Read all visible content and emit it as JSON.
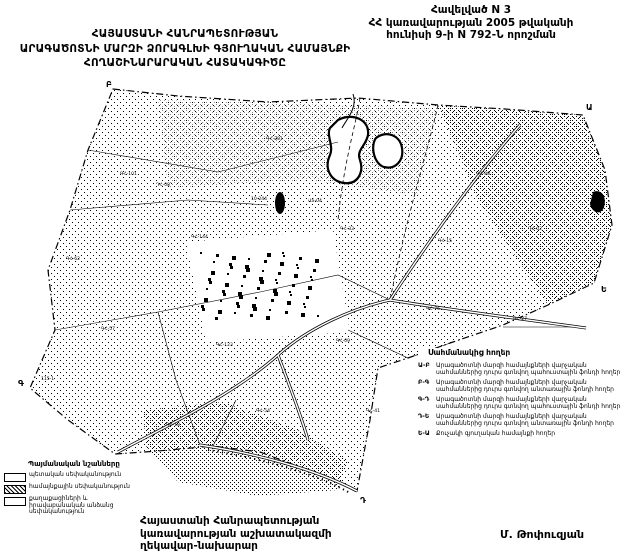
{
  "header": {
    "annex": {
      "line1": "Հավելված N 3",
      "line2": "ՀՀ կառավարության 2005 թվականի",
      "line3": "հունիսի 9-ի N 792-Ն որոշման"
    },
    "title": {
      "line1": "ՀԱՅԱՍՏԱՆԻ ՀԱՆՐԱՊԵՏՈՒԹՅԱՆ",
      "line2": "ԱՐԱԳԱԾՈՏՆԻ ՄԱՐԶԻ ՁՈՐԱԳԼԽԻ ԳՅՈՒՂԱԿԱՆ ՀԱՄԱՅՆՔԻ",
      "line3": "ՀՈՂԱՇԻՆԱՐԱՐԱԿԱՆ ՀԱՏԱԿԱԳԻԾԸ"
    }
  },
  "legend": {
    "title": "Պայմանական նշանները",
    "items": [
      {
        "swatch": "plain",
        "label": "պետական սեփականություն"
      },
      {
        "swatch": "dots",
        "label": "համայնքային սեփականություն"
      },
      {
        "swatch": "plain",
        "label": "քաղաքացիների և իրավաբանական անձանց սեփականություն"
      }
    ]
  },
  "adjacent_lands": {
    "title": "Սահմանակից հողեր",
    "entries": [
      {
        "code": "Ա-Բ",
        "text": "Արագածոտնի մարզի համայնքների վարչական սահմաններից դուրս գտնվող պահուստային ֆոնդի հողեր"
      },
      {
        "code": "Բ-Գ",
        "text": "Արագածոտնի մարզի համայնքների վարչական սահմաններից դուրս գտնվող անտառային ֆոնդի հողեր"
      },
      {
        "code": "Գ-Դ",
        "text": "Արագածոտնի մարզի համայնքների վարչական սահմաններից դուրս գտնվող պահուստային ֆոնդի հողեր"
      },
      {
        "code": "Դ-Ե",
        "text": "Արագածոտնի մարզի համայնքների վարչական սահմաններից դուրս գտնվող անտառային ֆոնդի հողեր"
      },
      {
        "code": "Ե-Ա",
        "text": "Քուչակի գյուղական համայնքի հողեր"
      }
    ]
  },
  "map": {
    "vertex_labels": [
      {
        "t": "Բ",
        "x": 98,
        "y": 7
      },
      {
        "t": "Ա",
        "x": 578,
        "y": 30
      },
      {
        "t": "Ե",
        "x": 593,
        "y": 212
      },
      {
        "t": "Դ",
        "x": 352,
        "y": 423
      },
      {
        "t": "Գ",
        "x": 10,
        "y": 306
      }
    ],
    "parcel_labels": [
      {
        "t": "ԳՀ-101",
        "x": 112,
        "y": 95
      },
      {
        "t": "ԴՀ-08",
        "x": 148,
        "y": 106
      },
      {
        "t": "ԳՀ-144",
        "x": 183,
        "y": 158
      },
      {
        "t": "ԳՀ-62",
        "x": 58,
        "y": 180
      },
      {
        "t": "ԳՀ-201",
        "x": 258,
        "y": 60
      },
      {
        "t": "10-244",
        "x": 243,
        "y": 120
      },
      {
        "t": "ՎՏ-04",
        "x": 300,
        "y": 122
      },
      {
        "t": "ԳՀ-33",
        "x": 332,
        "y": 150
      },
      {
        "t": "ԳՀ-88",
        "x": 468,
        "y": 95
      },
      {
        "t": "ԴՀ-02",
        "x": 520,
        "y": 150
      },
      {
        "t": "ԳՀ-15",
        "x": 430,
        "y": 162
      },
      {
        "t": "ԳՀ-27",
        "x": 505,
        "y": 240
      },
      {
        "t": "ԳՀ-57",
        "x": 93,
        "y": 250
      },
      {
        "t": "115-1",
        "x": 33,
        "y": 300
      },
      {
        "t": "ԳՀ-123",
        "x": 208,
        "y": 266
      },
      {
        "t": "ԳՀ-09",
        "x": 328,
        "y": 262
      },
      {
        "t": "ԳՀ-76",
        "x": 418,
        "y": 230
      },
      {
        "t": "ԳՀ-54",
        "x": 248,
        "y": 332
      },
      {
        "t": "ԳՀ-18",
        "x": 158,
        "y": 346
      },
      {
        "t": "ԳՀ-41",
        "x": 358,
        "y": 332
      }
    ]
  },
  "footer": {
    "line1": "Հայաստանի Հանրապետության",
    "line2": "կառավարության աշխատակազմի",
    "line3": "ղեկավար-նախարար",
    "signature": "Մ. Թոփուզյան"
  },
  "colors": {
    "ink": "#000000",
    "paper": "#ffffff"
  }
}
